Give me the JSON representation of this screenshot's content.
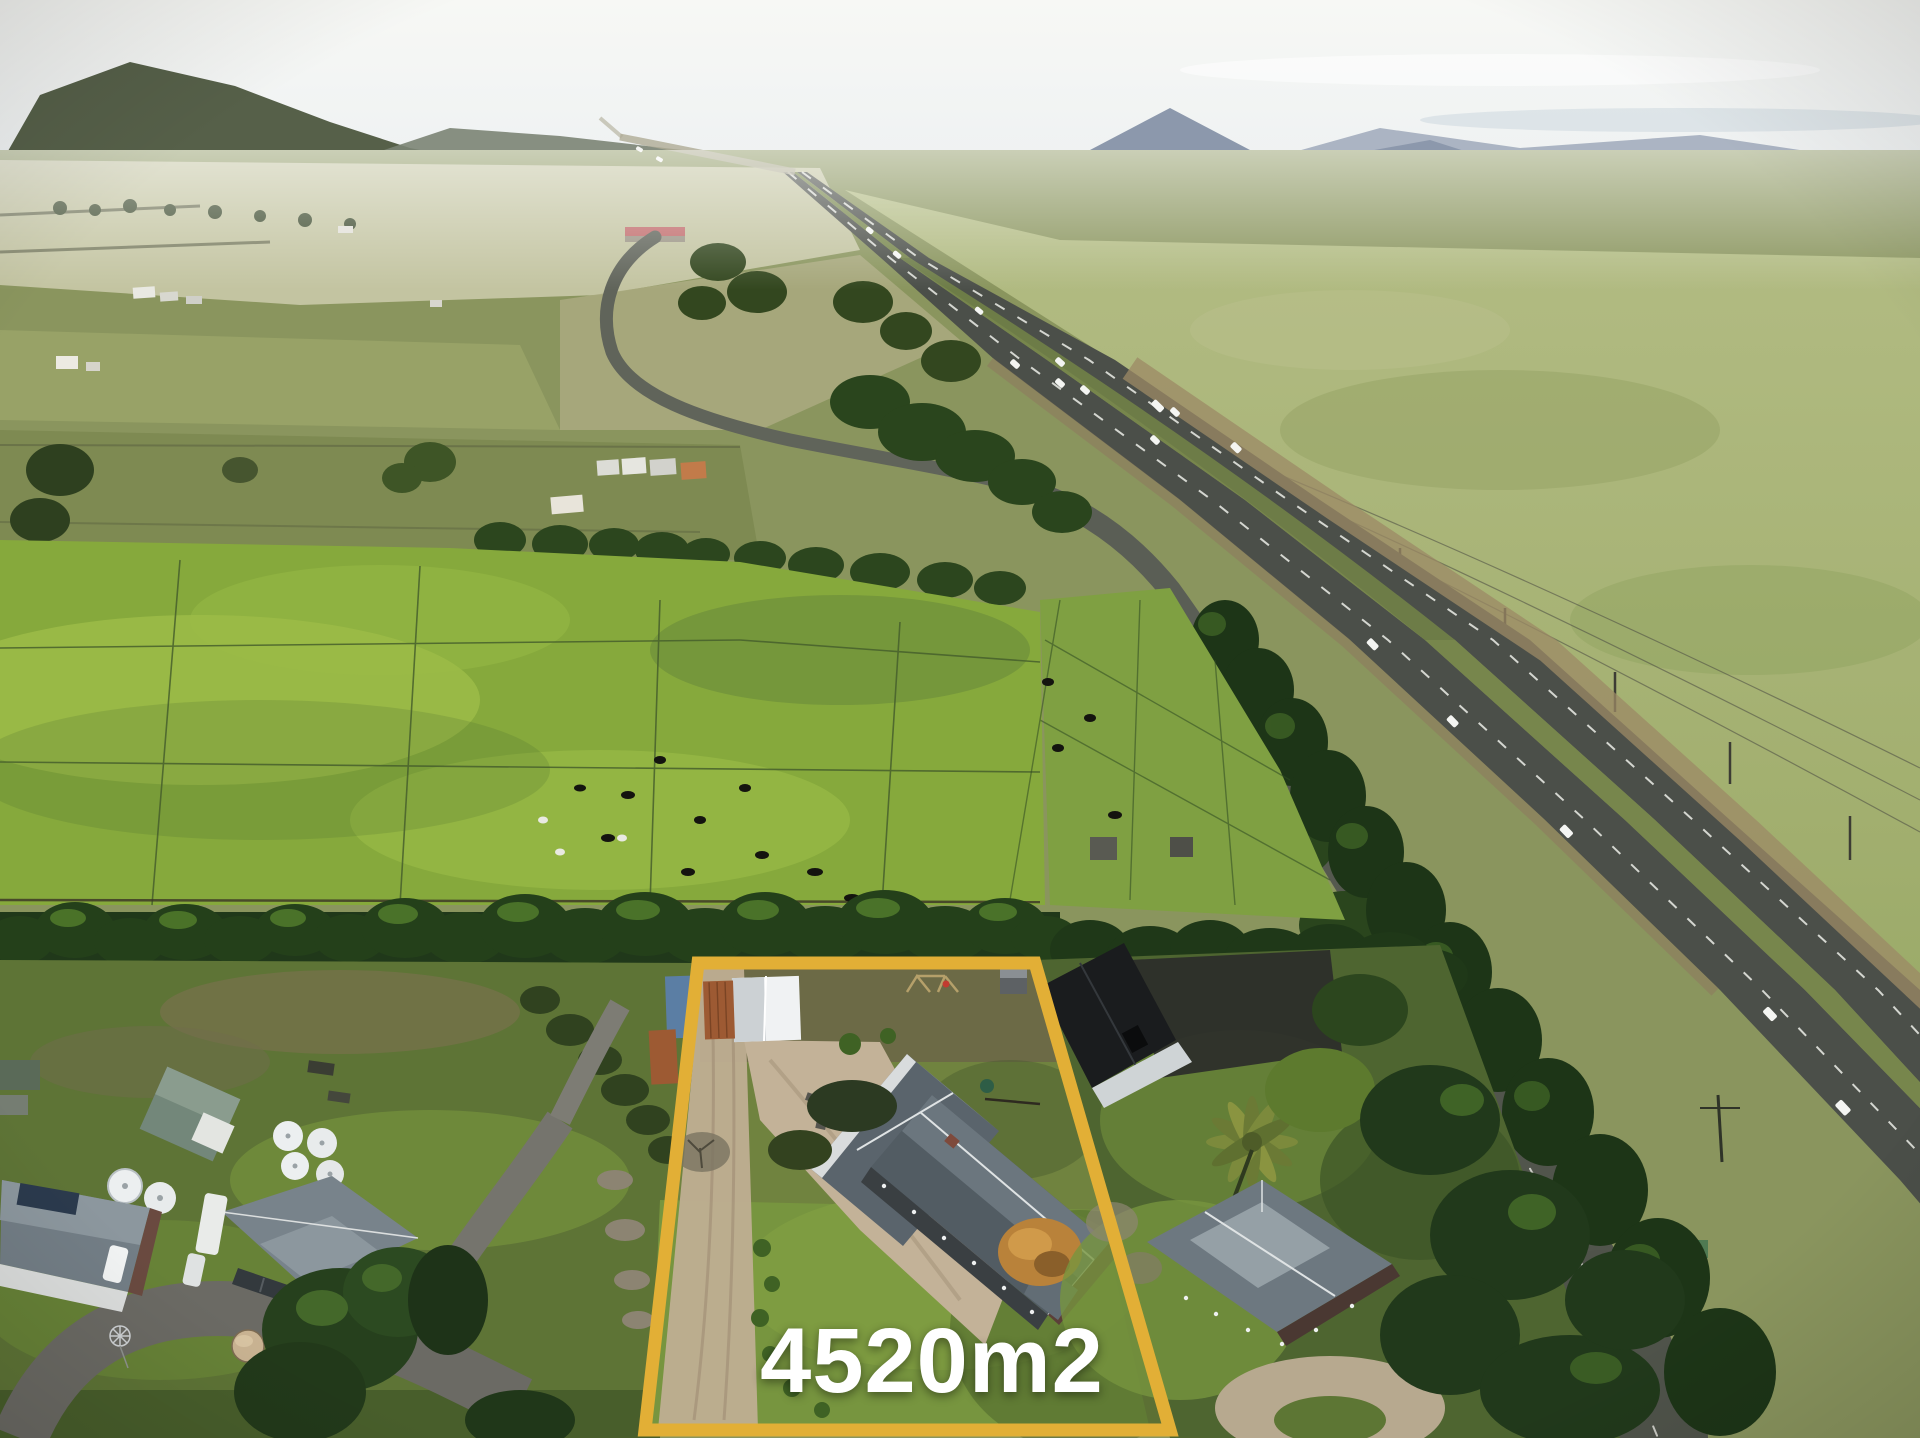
{
  "overlay": {
    "area_label": "4520m2"
  },
  "colors": {
    "boundary": "#e2af36",
    "label": "#ffffff",
    "pasture": "#86a93c",
    "asphalt": "#4b4f49",
    "sky": "#eef1f2",
    "mountain": "#7e8ba0",
    "gravel": "#c3b298",
    "roof": "#64707a",
    "barn": "#1a1c1e"
  }
}
